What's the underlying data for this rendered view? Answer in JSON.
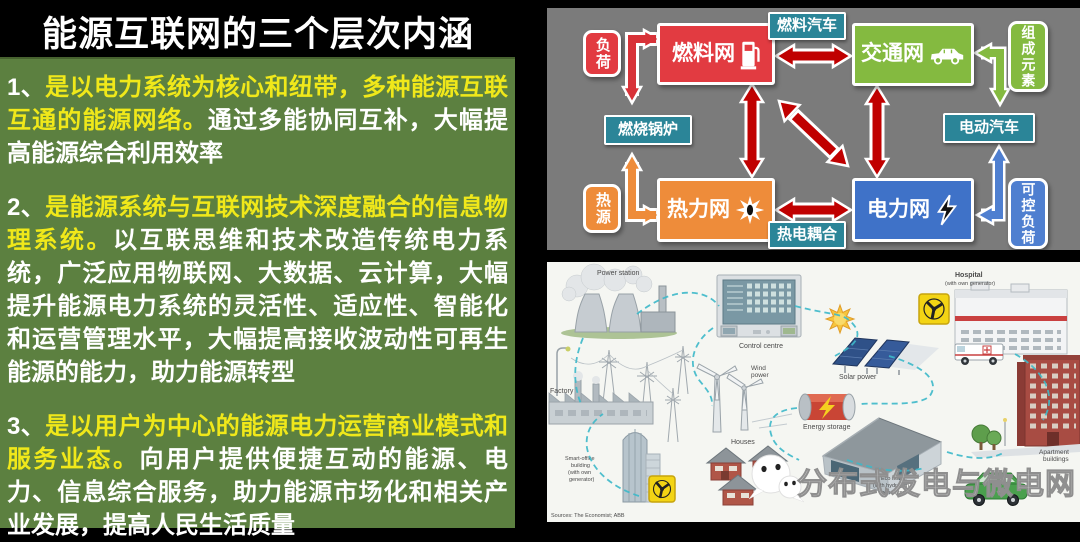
{
  "title": "能源互联网的三个层次内涵",
  "panel_left": {
    "bg_color": "#5c8040",
    "highlight_color": "#f0e81a",
    "text_color": "#ffffff",
    "paragraphs": [
      {
        "num": "1、",
        "highlight": "是以电力系统为核心和纽带，多种能源互联互通的能源网络。",
        "rest": "通过多能协同互补，大幅提高能源综合利用效率"
      },
      {
        "num": "2、",
        "highlight": "是能源系统与互联网技术深度融合的信息物理系统。",
        "rest": "以互联思维和技术改造传统电力系统，广泛应用物联网、大数据、云计算，大幅提升能源电力系统的灵活性、适应性、智能化和运营管理水平，大幅提高接收波动性可再生能源的能力，助力能源转型"
      },
      {
        "num": "3、",
        "highlight": "是以用户为中心的能源电力运营商业模式和服务业态。",
        "rest": "向用户提供便捷互动的能源、电力、信息综合服务，助力能源市场化和相关产业发展，提高人民生活质量"
      }
    ]
  },
  "diagram": {
    "bg_color": "#7b7b7b",
    "arrow_color": "#c00000",
    "colors": {
      "red": "#e23b41",
      "green": "#84ba40",
      "orange": "#ee8c3a",
      "blue": "#3f72c8",
      "blue_light": "#4f7fd0",
      "teal": "#2b8598"
    },
    "nodes": {
      "load": "负荷",
      "fuel_net": "燃料网",
      "fuel_vehicle": "燃料汽车",
      "transport_net": "交通网",
      "components": "组成元素",
      "boiler": "燃烧锅炉",
      "ev": "电动汽车",
      "heat_source": "热源",
      "heat_net": "热力网",
      "thermo_coupling": "热电耦合",
      "power_net": "电力网",
      "controllable_load": "可控负荷"
    }
  },
  "illustration": {
    "labels": {
      "power_station": "Power station",
      "control_centre": "Control centre",
      "wind_1": "Wind",
      "wind_2": "power",
      "solar_power": "Solar power",
      "energy_storage": "Energy storage",
      "hospital": "Hospital",
      "hospital_sub": "(with own generator)",
      "factory": "Factory",
      "smart_office_1": "Smart-office",
      "smart_office_2": "building",
      "smart_office_3": "(with own",
      "smart_office_4": "generator)",
      "houses": "Houses",
      "eco_house_1": "Eco house",
      "eco_house_2": "(with hydrogen",
      "eco_house_3": "generator)",
      "apartment_1": "Apartment",
      "apartment_2": "buildings",
      "sources": "Sources: The Economist; ABB"
    },
    "watermark": "分布式发电与微电网"
  }
}
